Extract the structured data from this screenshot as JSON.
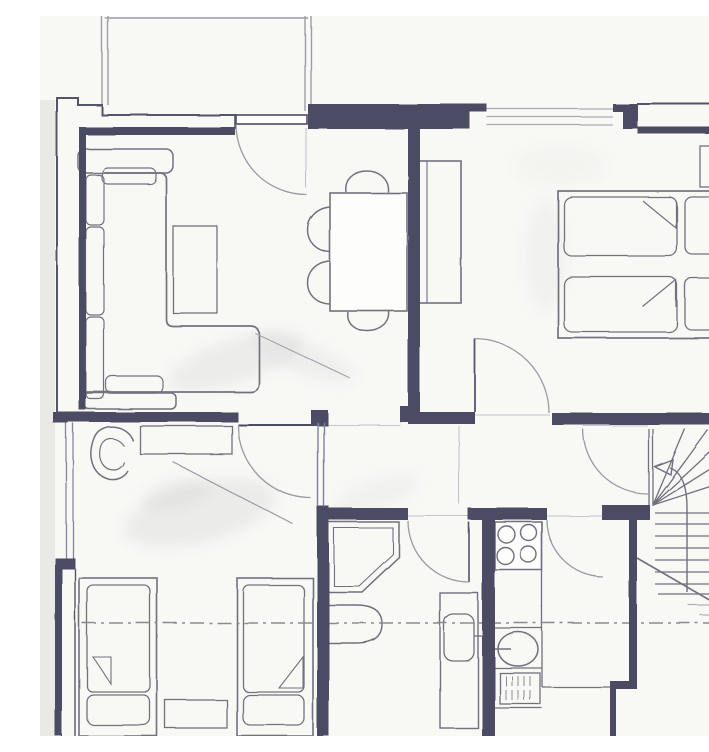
{
  "document": {
    "kind": "scanned hand-drawn apartment floor plan",
    "aria": "Hand-drawn apartment floor plan, scanned in blue-grey ink and pencil, no text labels"
  },
  "colors": {
    "paper": "#f8f8f5",
    "wall_ink": "#4b4b63",
    "wall_line": "#55556b",
    "pencil": "#72727f",
    "pencil_light": "#9c9ca8",
    "faint": "#c4c4cc",
    "dash_line": "#8a8a94",
    "margin_shadow": "#e9e9e6"
  },
  "rooms": {
    "living_room": {
      "label": "Living room",
      "furniture": [
        "corner sofa",
        "sofa side shelves",
        "coffee table",
        "dining table",
        "four chairs"
      ]
    },
    "bedroom_right": {
      "label": "Bedroom with double bed",
      "furniture": [
        "double bed",
        "two mattresses",
        "two pillows",
        "wardrobe",
        "bedside cabinet"
      ]
    },
    "bedroom_left": {
      "label": "Bedroom with twin beds",
      "furniture": [
        "twin bed left",
        "twin bed right",
        "tub armchair",
        "dresser",
        "bedside table"
      ]
    },
    "bathroom": {
      "label": "Bathroom",
      "fixtures": [
        "corner shower",
        "toilet",
        "washbasin unit"
      ]
    },
    "kitchen": {
      "label": "Kitchen strip",
      "fixtures": [
        "four-burner hob",
        "counter",
        "sink with tap",
        "drainer rack"
      ]
    },
    "hall": {
      "label": "Hallway"
    },
    "stairs": {
      "label": "Winder staircase",
      "arrow_direction": "up, curving left"
    },
    "balcony": {
      "label": "Balcony above, cropped at top edge"
    }
  },
  "openings": {
    "balcony_door": {
      "label": "Balcony door in top wall, swing arc into living room"
    },
    "window_top": {
      "label": "Window in top wall of right bedroom"
    },
    "window_left": {
      "label": "Window in left wall of lower bedroom"
    },
    "door_bedroom_right": {
      "label": "Door to right bedroom, leaf open"
    },
    "door_bedroom_left": {
      "label": "Door to lower-left bedroom, leaf closed with swing arc"
    },
    "door_bathroom": {
      "label": "Bathroom door, leaf open"
    },
    "door_kitchen": {
      "label": "Kitchen door swing arc"
    },
    "door_stairs": {
      "label": "Door at top of staircase"
    }
  },
  "annotations": {
    "section_cut": {
      "label": "Horizontal dash-dot section cut line across whole plan"
    },
    "pencil_shading": {
      "label": "Grey pencil smudges on floors"
    }
  }
}
